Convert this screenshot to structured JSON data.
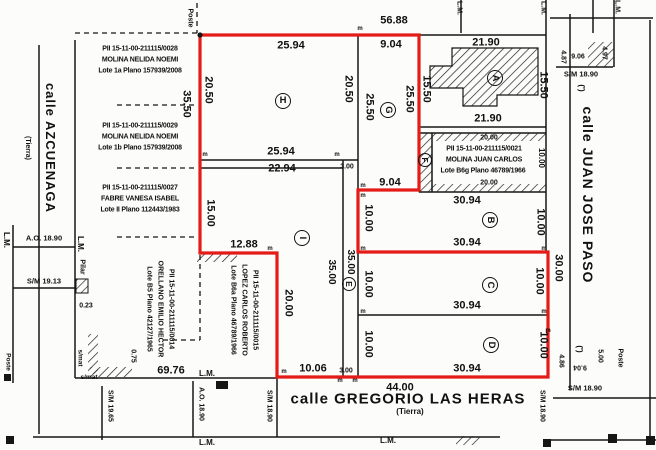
{
  "plan_labels": {
    "lm": "L.M.",
    "poste": "Poste",
    "pilar": "Pilar",
    "smat": "s/mat",
    "prime": "(')",
    "m_mark": "m"
  },
  "streets": {
    "azcuenaga": {
      "name": "calle AZCUENAGA",
      "type": "(Tierra)"
    },
    "juan_jose_paso": {
      "name": "calle JUAN JOSE PASO"
    },
    "gregorio_las_heras": {
      "name": "calle GREGORIO LAS HERAS",
      "type": "(Tierra)"
    }
  },
  "parcels": {
    "a": "A",
    "b": "B",
    "c": "C",
    "d": "D",
    "e": "E",
    "f": "F",
    "g": "G",
    "h": "H",
    "i": "I"
  },
  "adjacent_lots": {
    "lot_1a": {
      "pii": "PII 15-11-00-211115/0028",
      "owner": "MOLINA NELIDA NOEMI",
      "lote": "Lote 1a Plano 157939/2008"
    },
    "lot_1b": {
      "pii": "PII 15-11-00-211115/0029",
      "owner": "MOLINA NELIDA NOEMI",
      "lote": "Lote 1b Plano 157939/2008"
    },
    "lot_ii": {
      "pii": "PII 15-11-00-211115/0027",
      "owner": "FABRE VANESA ISABEL",
      "lote": "Lote II Plano 112443/1983"
    },
    "lot_b6g": {
      "pii": "PII 15-11-00-211115/0021",
      "owner": "MOLINA JUAN CARLOS",
      "lote": "Lote B6g Plano 46789/1966"
    },
    "lot_b5": {
      "pii": "PII 15-11-00-211115/0014",
      "owner": "ORELLANO EMILIO HECTOR",
      "lote": "Lote B5 Plano 42127/1965"
    },
    "lot_b6a": {
      "pii": "PII 15-11-00-211115/0015",
      "owner": "LOPEZ CARLOS ROBERTO",
      "lote": "Lote B6a Plano 46789/1966"
    }
  },
  "measurements": {
    "top_total": "56.88",
    "h_top": "25.94",
    "g_top": "9.04",
    "a_top": "21.90",
    "h_left": "20.50",
    "h_right": "20.50",
    "h_bottom": "25.94",
    "g_left": "25.50",
    "g_right": "25.50",
    "g_bottom": "9.04",
    "a_left": "15.50",
    "a_right": "15.50",
    "a_bottom": "21.90",
    "lots_left_depth": "35.50",
    "i_top": "22.94",
    "i_left": "15.00",
    "i_step": "12.88",
    "i_depth": "35.00",
    "i_left_lower": "20.00",
    "i_bottom": "10.06",
    "e_top": "3.00",
    "e_depth": "35.00",
    "e_bottom": "3.00",
    "b6g_top": "20.00",
    "b6g_bottom": "20.00",
    "b6g_right": "10.00",
    "b_top": "30.94",
    "b_bottom": "30.94",
    "b_left": "10.00",
    "b_right": "10.00",
    "c_bottom": "30.94",
    "c_left": "10.00",
    "c_right": "10.00",
    "d_bottom": "30.94",
    "d_left": "10.00",
    "d_right": "10.00",
    "bcd_right_total": "30.00",
    "bottom_total": "44.00",
    "block_south_side": "69.76",
    "paso_top_a": "4.87",
    "paso_top_b": "9.06",
    "paso_top_c": "4.97",
    "paso_top_sm": "S/M 18.90",
    "paso_bottom_a": "4.86",
    "paso_bottom_b": "9.04",
    "paso_bottom_c": "5.00",
    "paso_bottom_sm": "S/M 18.90",
    "paso_side_sm": "S/M 18.90",
    "azcuenaga_ao": "A.O. 18.90",
    "azcuenaga_sm": "S/M 19.13",
    "heras_sm_west": "S/M 19.65",
    "heras_ao": "A.O. 18.90",
    "heras_sm_east": "S/M 18.90",
    "pilar_offset": "0.23",
    "wall_offset": "0.75"
  }
}
